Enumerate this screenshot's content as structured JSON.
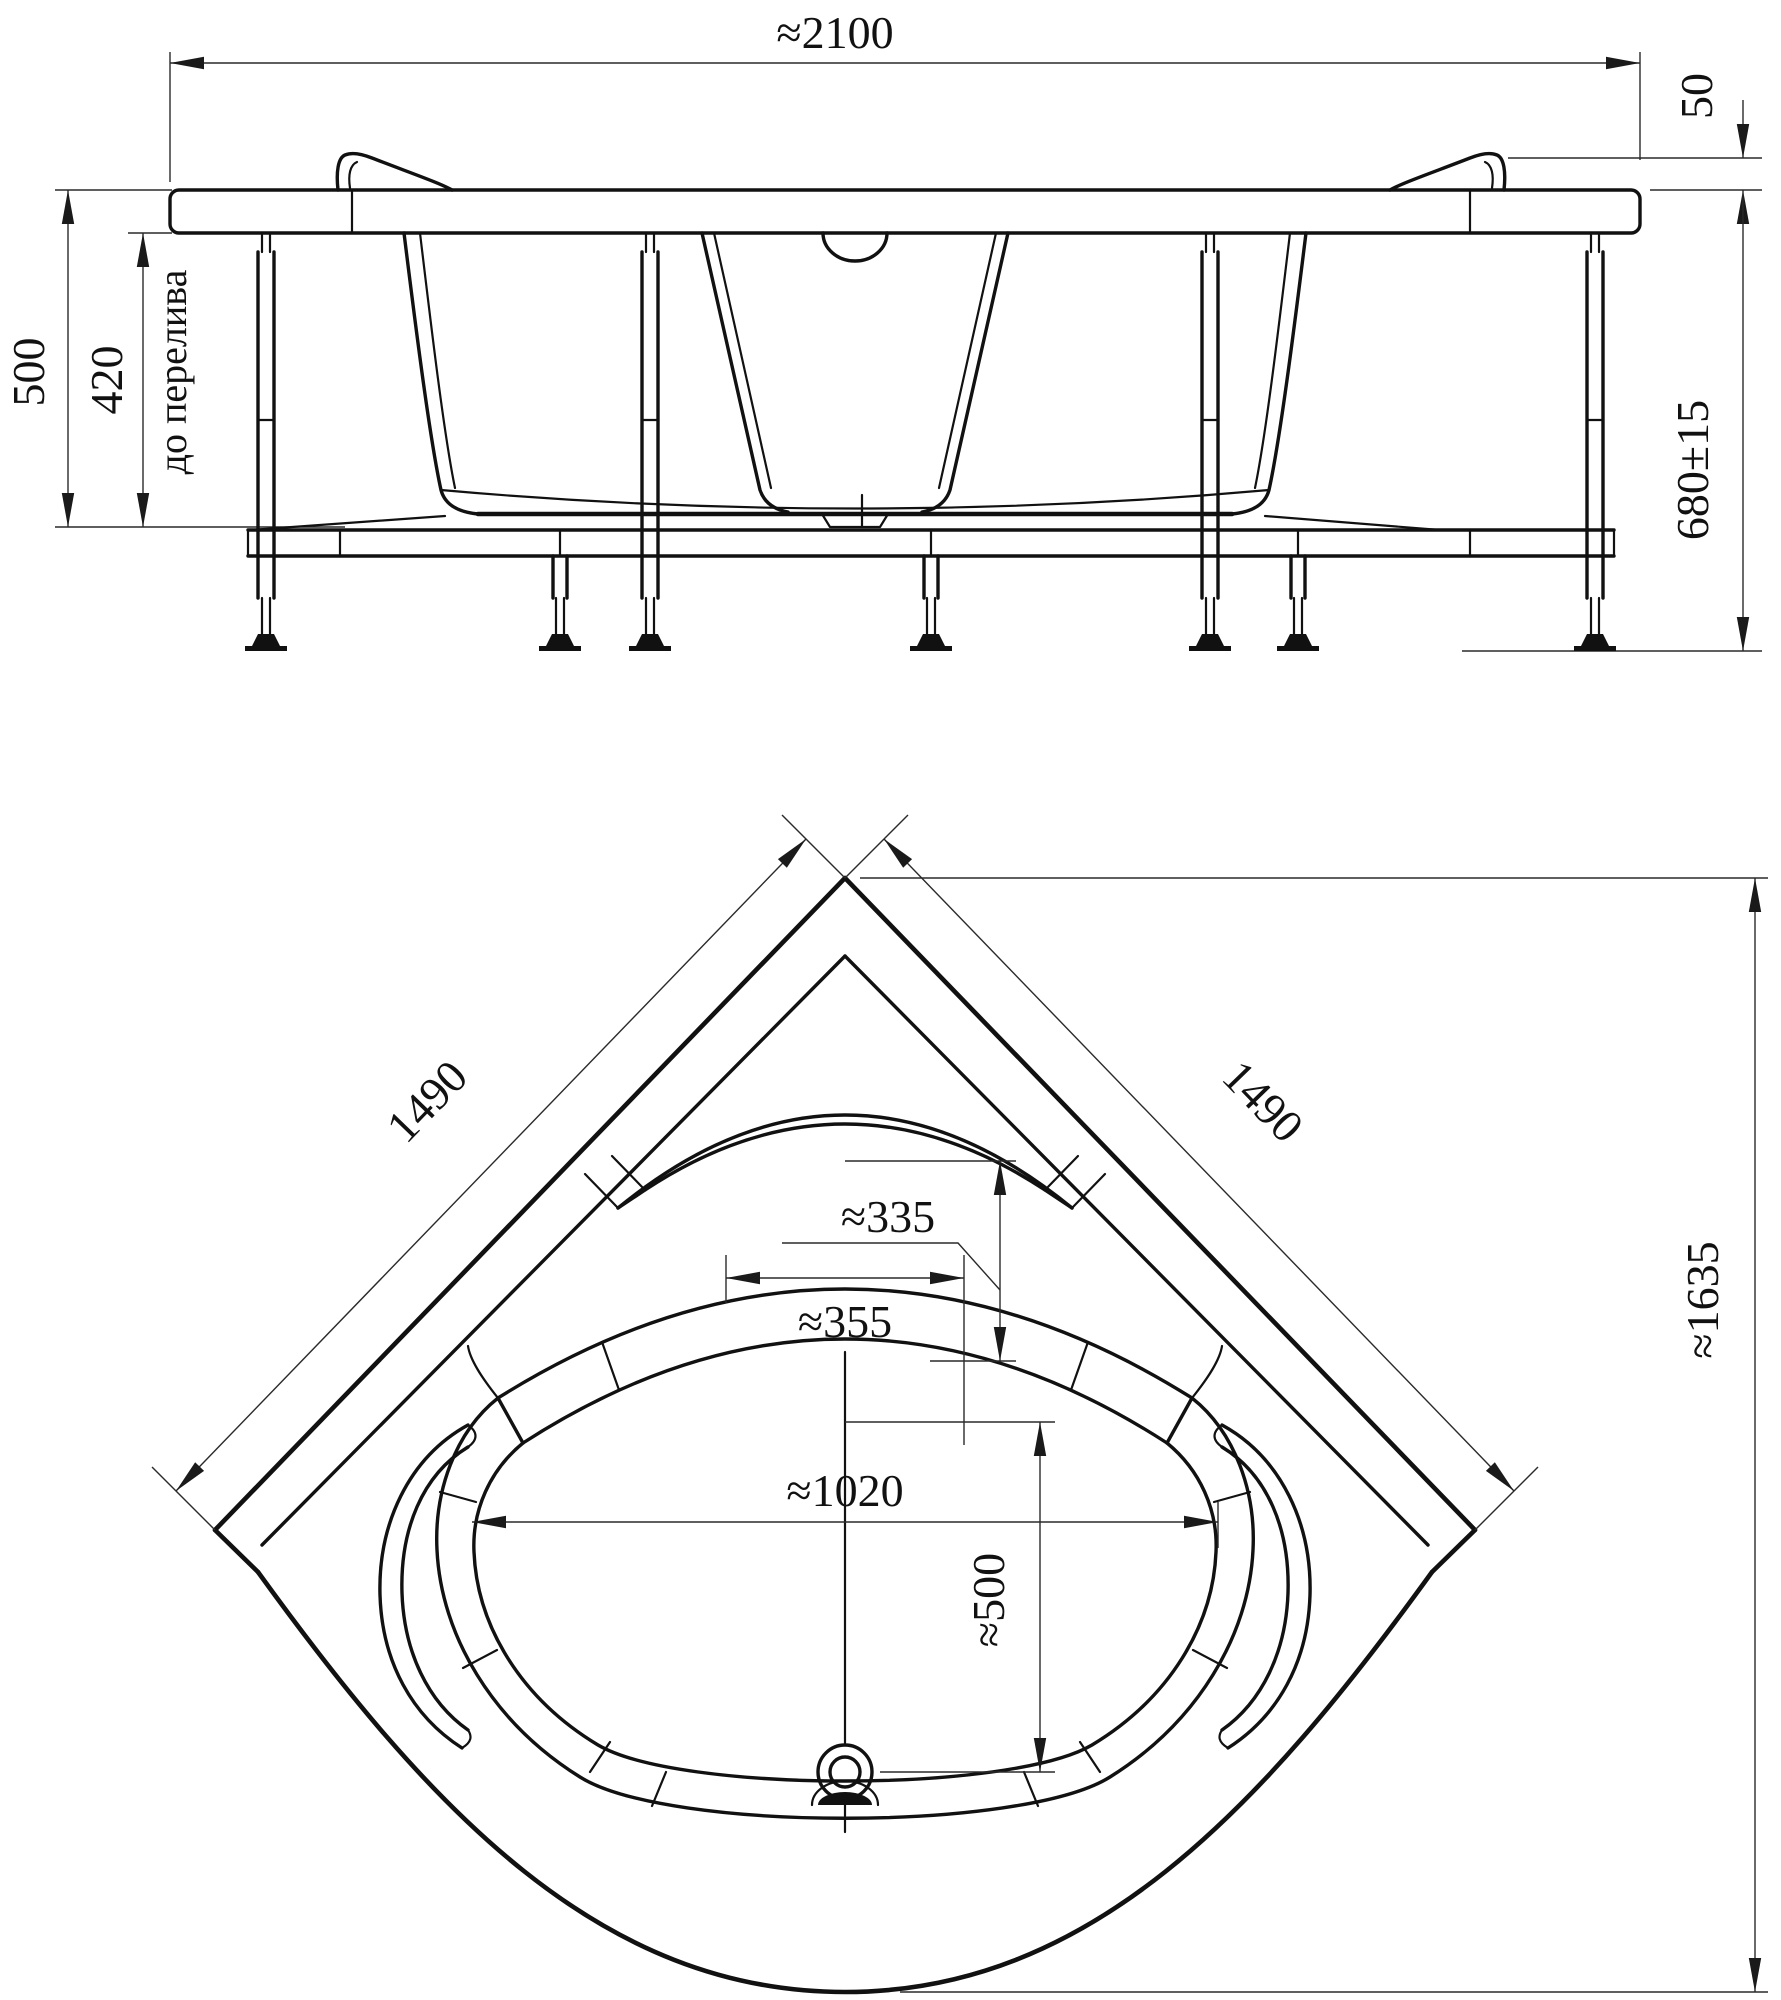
{
  "front_view": {
    "overall_width": "≈2100",
    "headrest_height": "50",
    "inner_depth": "500",
    "overflow_depth": "420",
    "overflow_note": "до перелива",
    "overall_height": "680±15"
  },
  "plan_view": {
    "left_side": "1490",
    "right_side": "1490",
    "headrest_depth": "≈335",
    "headrest_width": "≈355",
    "bowl_width": "≈1020",
    "drain_distance": "≈500",
    "corner_to_front": "≈1635"
  }
}
